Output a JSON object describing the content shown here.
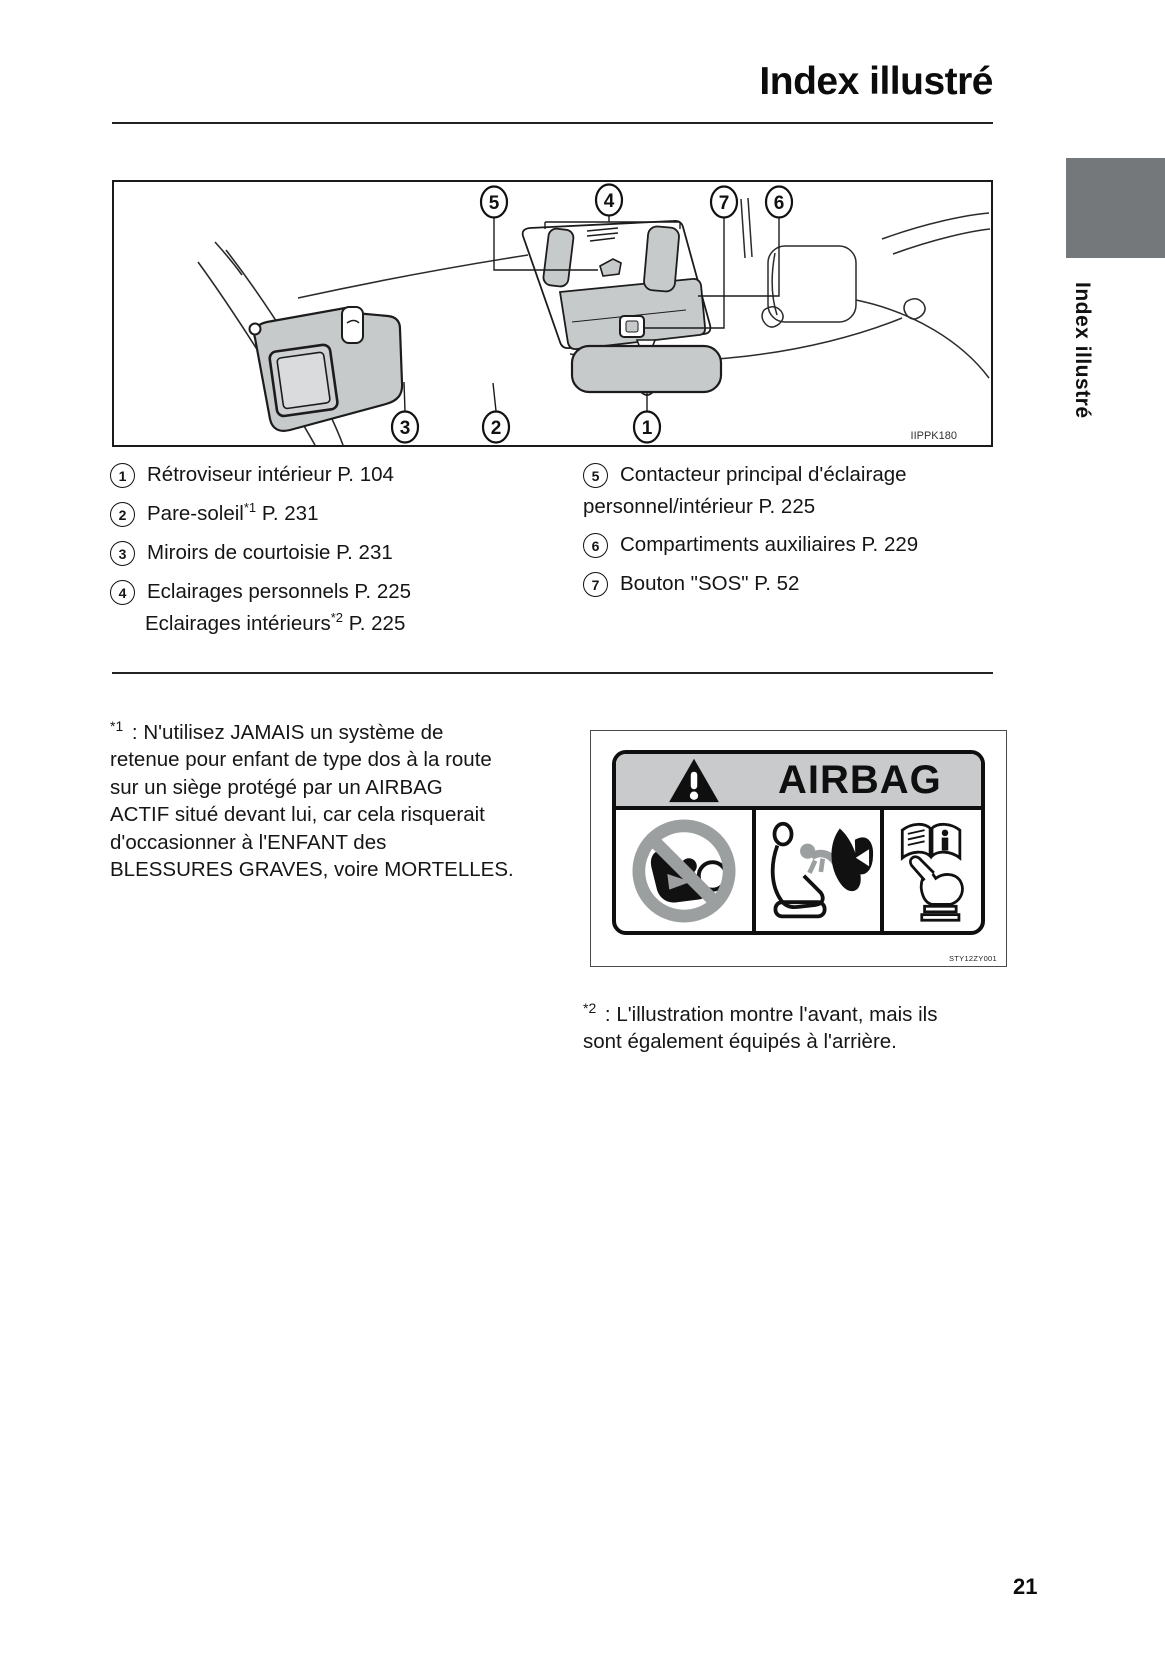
{
  "page": {
    "title": "Index illustré",
    "number": "21"
  },
  "sidebar_tab": {
    "label": "Index illustré",
    "color": "#75787b"
  },
  "figure": {
    "code": "IIPPK180",
    "callouts": {
      "top": [
        "5",
        "4",
        "7",
        "6"
      ],
      "bottom": [
        "3",
        "2",
        "1"
      ]
    }
  },
  "legend": {
    "items_left": [
      {
        "num": "1",
        "pre": "Rétroviseur intérieur P. 104",
        "sup": "",
        "post": ""
      },
      {
        "num": "2",
        "pre": "Pare-soleil",
        "sup": "*1",
        "post": " P. 231"
      },
      {
        "num": "3",
        "pre": "Miroirs de courtoisie P. 231",
        "sup": "",
        "post": ""
      },
      {
        "num": "4",
        "pre": "Eclairages personnels P. 225",
        "sup": "",
        "post": "",
        "line2_pre": "Eclairages intérieurs",
        "line2_sup": "*2",
        "line2_post": " P. 225"
      }
    ],
    "items_right": [
      {
        "num": "5",
        "pre": "Contacteur principal d'éclairage",
        "line2": "personnel/intérieur P. 225"
      },
      {
        "num": "6",
        "pre": "Compartiments auxiliaires P. 229"
      },
      {
        "num": "7",
        "pre": "Bouton \"SOS\" P. 52"
      }
    ]
  },
  "footnotes": {
    "fn1": {
      "marker": "*1",
      "text": " : N'utilisez JAMAIS un système de\nretenue pour enfant de type dos à la route\nsur un siège protégé par un AIRBAG\nACTIF situé devant lui, car cela risquerait\nd'occasionner à l'ENFANT des\nBLESSURES GRAVES, voire MORTELLES."
    },
    "fn2": {
      "marker": "*2",
      "text": " : L'illustration montre l'avant, mais ils\nsont également équipés à l'arrière."
    }
  },
  "airbag_label": {
    "title": "AIRBAG",
    "code": "STY12ZY001",
    "header_bg": "#c8cacb"
  },
  "icons": {
    "warning_triangle": "black triangle + white exclamation",
    "no_rear_facing_child_seat": "grey prohibition circle over child seat + airbag",
    "airbag_deployment": "seat profile + deploying airbag pictogram",
    "read_owners_manual": "open book + pointing hand pictogram"
  }
}
